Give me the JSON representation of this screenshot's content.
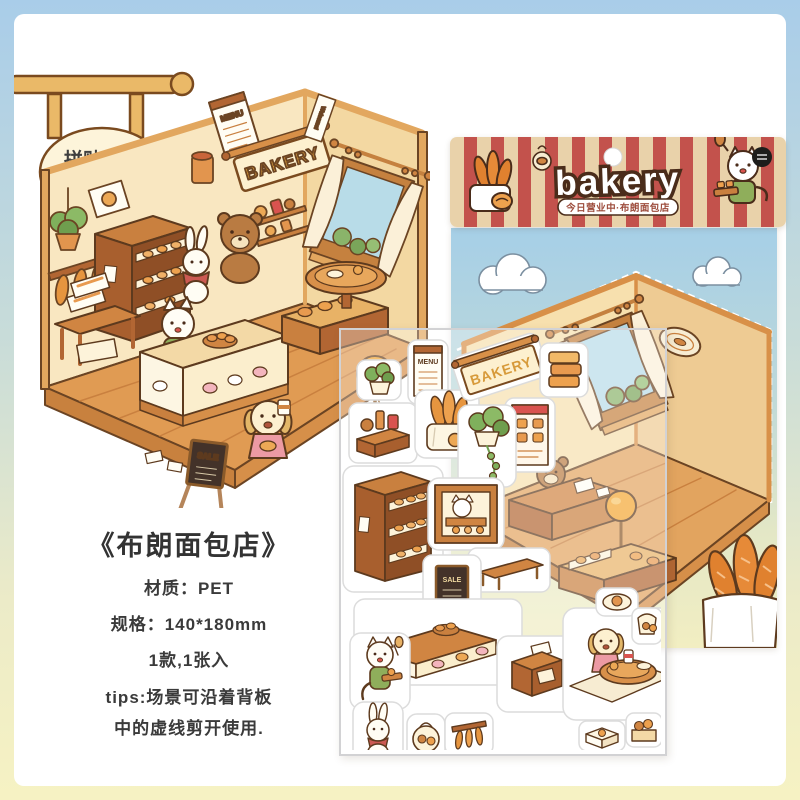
{
  "colors": {
    "frame_top": "#a9cde9",
    "frame_bottom": "#f6f2c3",
    "card_bg": "#ffffff",
    "stripe_red": "#c3524c",
    "stripe_tan": "#e9d2aa",
    "sky": "#a6cfe7",
    "wood": "#d89048",
    "wall_light": "#f9e7c1",
    "wall_dark": "#f3d8a2",
    "floor": "#e09b53",
    "outline": "#5d3a1e",
    "ink": "#333333",
    "accent_green": "#8fae5b"
  },
  "hanging_sign": {
    "line1": "拼贴效果",
    "line2": "参考图"
  },
  "reference_scene": {
    "bakery_sign": "BAKERY",
    "menu_poster": "MENU",
    "sale_board": "SALE",
    "welcome_banner": "Welcome!"
  },
  "info": {
    "title": "《布朗面包店》",
    "material": "材质：PET",
    "spec": "规格：140*180mm",
    "pack": "1款,1张入",
    "tips_line1": "tips:场景可沿着背板",
    "tips_line2": "中的虚线剪开使用."
  },
  "product": {
    "header": {
      "logo": "bakery",
      "subtitle": "今日营业中·布朗面包店"
    },
    "stickers": {
      "bakery_sign": "BAKERY",
      "menu_poster": "MENU",
      "sale_board": "SALE"
    }
  }
}
